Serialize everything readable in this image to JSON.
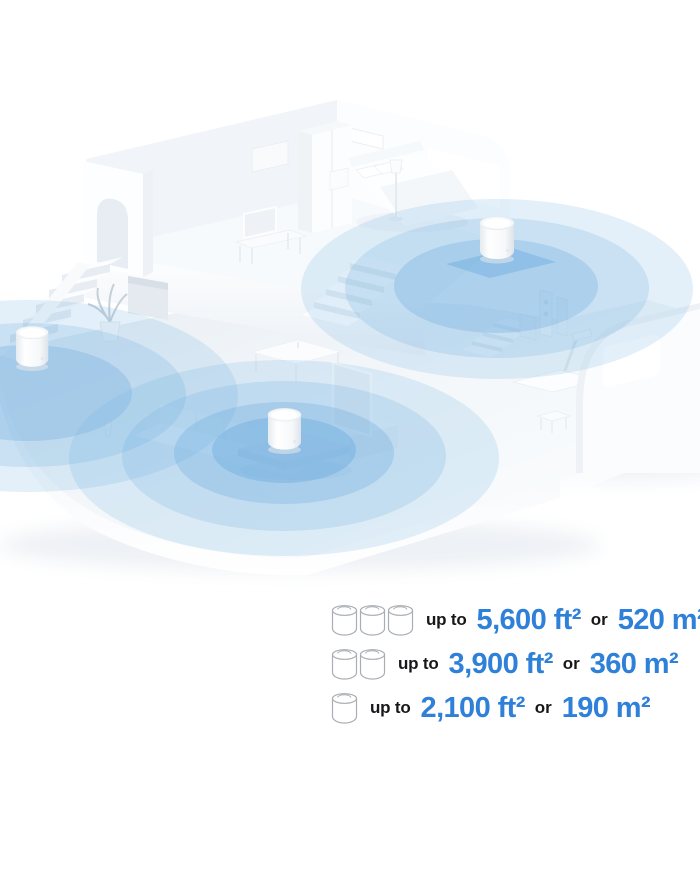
{
  "colors": {
    "accent_blue": "#2e80d9",
    "coverage_blue": "#74b2e2",
    "text_dark": "#17181a"
  },
  "coverage_rows": [
    {
      "units": 3,
      "prefix": "up to",
      "area_ft": "5,600 ft²",
      "conj": "or",
      "area_m": "520 m²"
    },
    {
      "units": 2,
      "prefix": "up to",
      "area_ft": "3,900 ft²",
      "conj": "or",
      "area_m": "360 m²"
    },
    {
      "units": 1,
      "prefix": "up to",
      "area_ft": "2,100 ft²",
      "conj": "or",
      "area_m": "190 m²"
    }
  ]
}
